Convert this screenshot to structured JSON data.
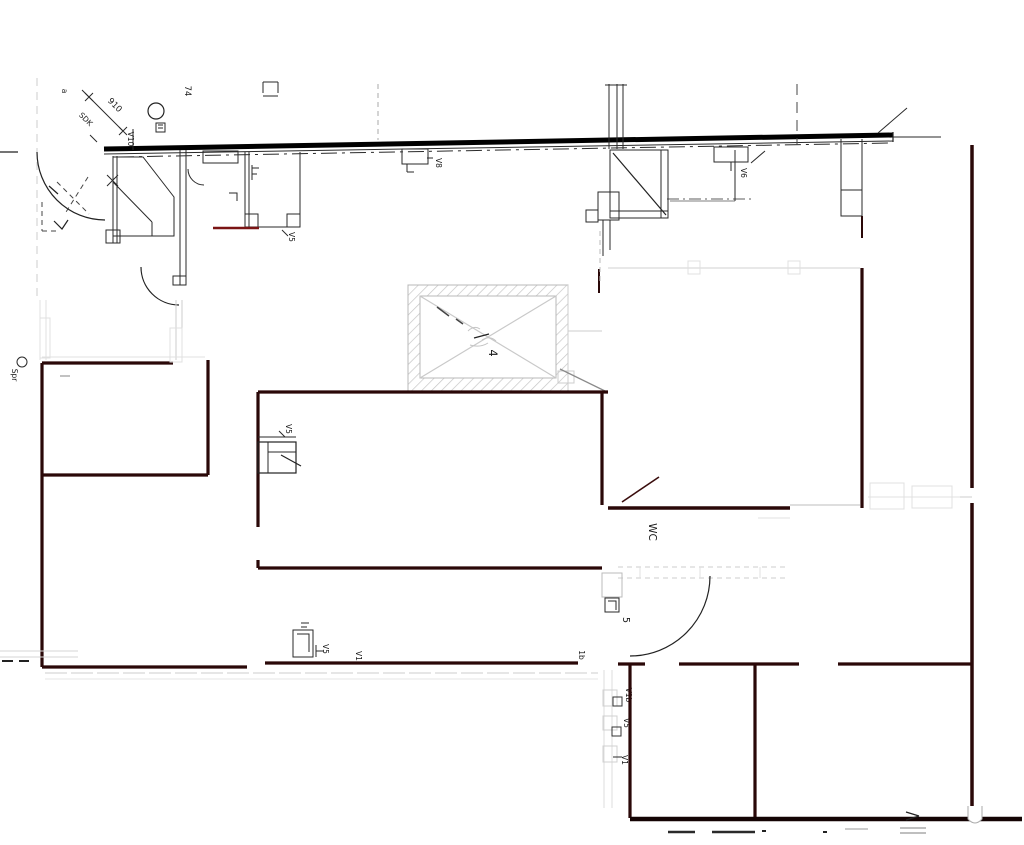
{
  "drawing": {
    "type": "architectural-floor-plan",
    "colors": {
      "background": "#ffffff",
      "exterior_wall": "#000000",
      "interior_wall": "#2a0808",
      "accent_red": "#7a1414",
      "detail_gray": "#cccccc",
      "text": "#1a1a1a"
    },
    "labels": {
      "dim_910": "910",
      "sdk": "SDK",
      "v10": "V10",
      "num_74": "74",
      "letter_a": "a",
      "v5_room_top": "V5",
      "v8": "V8",
      "v6": "V6",
      "shaft_4": "4",
      "spr": "Spr",
      "v5_center": "V5",
      "wc": "WC",
      "room_5": "5",
      "label_1b": "1b",
      "v5_bottom": "V5",
      "v1_bottom": "V1",
      "v1b_col": "V1b",
      "v5_col": "V5",
      "v1_col": "V1"
    }
  }
}
